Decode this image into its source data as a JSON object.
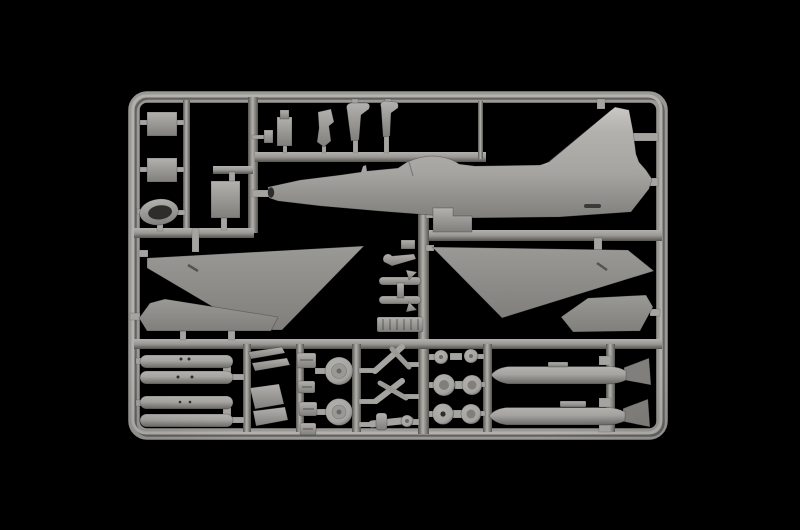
{
  "scene": {
    "description": "photograph of an injection-molded plastic model kit sprue on a black background",
    "subject": "gray plastic aircraft model parts frame (jet fighter kit sprue)"
  },
  "colors": {
    "background": "#000000",
    "highlight": "#c9c8c4",
    "base_light": "#b2b1ad",
    "plastic": "#a5a4a0",
    "base": "#9a9995",
    "shadow": "#807f7c",
    "dark": "#6b6a67",
    "deep": "#55544f",
    "hole": "#2e2d2b"
  },
  "sprue": {
    "frame_shape": "rounded rectangle runner frame",
    "parts": [
      {
        "id": "fuselage-half",
        "count": 1
      },
      {
        "id": "lower-wing-panel",
        "count": 2
      },
      {
        "id": "wing-insert-panel",
        "count": 2
      },
      {
        "id": "drop-tank-half",
        "count": 4
      },
      {
        "id": "finned-underwing-store",
        "count": 2
      },
      {
        "id": "main-wheel",
        "count": 2
      },
      {
        "id": "small-wheel",
        "count": 6
      },
      {
        "id": "intake-lip-ring",
        "count": 1
      },
      {
        "id": "rectangular-panel",
        "count": 3
      },
      {
        "id": "stepped-fairing",
        "count": 1
      },
      {
        "id": "ejection-seat",
        "count": 1
      },
      {
        "id": "cockpit-part",
        "count": 1
      },
      {
        "id": "hooked-gear-leg",
        "count": 2
      },
      {
        "id": "landing-gear-strut",
        "count": 3
      },
      {
        "id": "gear-door",
        "count": 4
      },
      {
        "id": "small-fitting",
        "count": 4
      },
      {
        "id": "axle-assembly",
        "count": 1
      },
      {
        "id": "ribbed-panel",
        "count": 1
      },
      {
        "id": "linkage",
        "count": 2
      }
    ]
  }
}
